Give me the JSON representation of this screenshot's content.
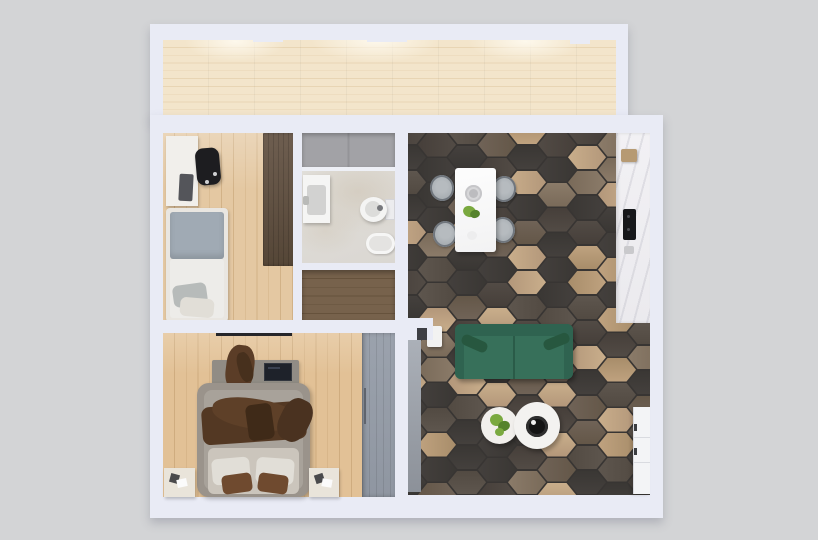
{
  "meta": {
    "description": "Top-down 3D render of a small apartment floor plan on a gray background",
    "visible_text": []
  },
  "rooms": [
    {
      "name": "balcony",
      "floor": "light wood planks"
    },
    {
      "name": "office-bedroom",
      "floor": "light oak",
      "furniture": [
        "desk",
        "office-chair",
        "single-bed",
        "walnut-wardrobe"
      ]
    },
    {
      "name": "bathroom",
      "floor": "marble tile",
      "furniture": [
        "shower",
        "sink",
        "toilet",
        "bathtub"
      ]
    },
    {
      "name": "closet",
      "floor": "dark wood planks",
      "furniture": []
    },
    {
      "name": "bedroom",
      "floor": "light oak",
      "furniture": [
        "double-bed",
        "brown-throw",
        "dresser-with-tv",
        "gray-wardrobe",
        "nightstand-left",
        "nightstand-right"
      ]
    },
    {
      "name": "living-dining-kitchen",
      "floor": "hexagonal tiles",
      "furniture": [
        "dining-table",
        "four-chairs",
        "green-sofa",
        "side-table",
        "coffee-table-small",
        "coffee-table-large",
        "kitchen-counter",
        "white-cabinet"
      ]
    }
  ],
  "palette": {
    "bg": "#d3d4d6",
    "wall": "#e9ebf5",
    "balconyFloor": "#f3e5cb",
    "balconyPlank": "#e8d5b4",
    "balconyGlow": "#fdf8ec",
    "oakFloor": "#e4c8a2",
    "oakPlank": "#d2b287",
    "oakFloor2": "#e2c196",
    "oakPlank2": "#cfac7f",
    "closetFloor": "#77624c",
    "closetPlank": "#66523c",
    "shower": "#a2a2a6",
    "showerPanel": "#949498",
    "entryA": "#abb0b8",
    "entryB": "#8c9199",
    "grout": "#383533",
    "deskWhite": "#f1efeb",
    "chairBlack": "#1d1d20",
    "monitorGray": "#54555a",
    "bedFrame1": "#e9e6e1",
    "blanketBlue": "#a0aab4",
    "duvetWhite": "#edece9",
    "pillowGray": "#b7bbba",
    "pillowWhite": "#e1ded7",
    "dresserGray": "#918c85",
    "clothBrown": "#5b3d27",
    "clothBrownDark": "#47301d",
    "tvBlack": "#1e222a",
    "bedFrame2": "#9a938b",
    "mattress": "#a8a29a",
    "sheet": "#cbc5bc",
    "throwBrown": "#533823",
    "throwDark": "#3f2a18",
    "throwMid": "#5e4028",
    "pillowBrown": "#6f4a2f",
    "nightstand": "#e9e4da",
    "tableWhite": "#fbfbfb",
    "plate": "#d7d7d9",
    "plateInner": "#bcbcbf",
    "plant": "#7aa93f",
    "plantDark": "#55832c",
    "chairSeat": "#a4aaaf",
    "chairRim": "#70767d",
    "chairLight": "#b6bbbf",
    "sofa": "#37705a",
    "sofaDark": "#2f6350",
    "sofaSeam": "#2a5b48",
    "bolster": "#27573f",
    "sideTable": "#f2f2f1",
    "coffeeTable": "#f1efec",
    "coffeeTable2": "#f3f2f0",
    "tray": "#141414",
    "counter": "#f2f1f4",
    "counterWood": "#b69a73",
    "counterBlack": "#17181b",
    "cabinet": "#f3f4f6",
    "cabinetLine": "#d9dbe0",
    "handle": "#3c3e42",
    "sink": "#f5f5f4",
    "basin": "#d2d2d1",
    "fixture": "#b9bab8",
    "toilet": "#f4f4f3",
    "toiletInner": "#dcdcda",
    "toiletDark": "#77787c",
    "tub": "#f6f6f5",
    "tubInner": "#e4e3e1",
    "blackLine": "#26262a",
    "notch": "#3e3f44"
  },
  "tiles": {
    "seed": 12,
    "hexW": 40,
    "hexH": 25,
    "colStep": 30,
    "rowH": 25,
    "palette": [
      [
        "#44403d",
        "#3a3734"
      ],
      [
        "#524b45",
        "#463f3a"
      ],
      [
        "#5e564e",
        "#524a42"
      ],
      [
        "#706357",
        "#645748"
      ],
      [
        "#c9ae8b",
        "#b3977a"
      ],
      [
        "#bfa27f",
        "#a88d6a"
      ],
      [
        "#8b7b69",
        "#796a59"
      ]
    ],
    "weights": [
      26,
      20,
      12,
      8,
      14,
      10,
      10
    ]
  }
}
